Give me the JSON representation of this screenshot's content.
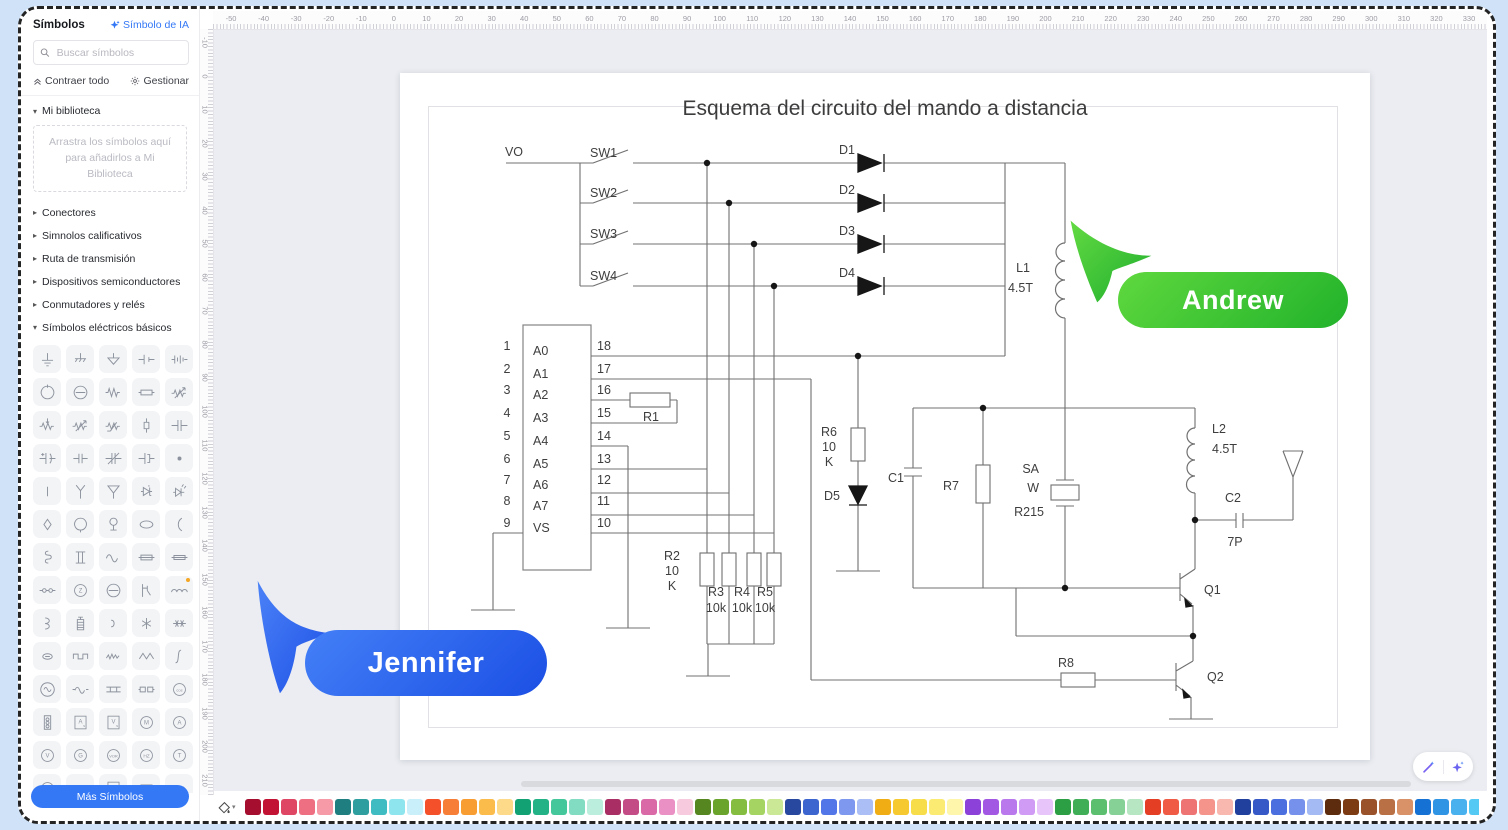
{
  "sidebar": {
    "title": "Símbolos",
    "ai_button": "Símbolo de IA",
    "search_placeholder": "Buscar símbolos",
    "collapse_all": "Contraer todo",
    "manage": "Gestionar",
    "library": {
      "label": "Mi biblioteca",
      "dropzone": "Arrastra los símbolos aquí para añadirlos a Mi Biblioteca"
    },
    "categories": [
      {
        "label": "Conectores",
        "expanded": false
      },
      {
        "label": "Simnolos calificativos",
        "expanded": false
      },
      {
        "label": "Ruta de transmisión",
        "expanded": false
      },
      {
        "label": "Dispositivos semiconductores",
        "expanded": false
      },
      {
        "label": "Conmutadores y relés",
        "expanded": false
      },
      {
        "label": "Símbolos eléctricos básicos",
        "expanded": true
      }
    ],
    "symbols": [
      {
        "n": "earth-ground",
        "g": "gnd1"
      },
      {
        "n": "chassis-ground",
        "g": "gnd2"
      },
      {
        "n": "signal-ground",
        "g": "gnd3"
      },
      {
        "n": "cell",
        "g": "cell"
      },
      {
        "n": "battery",
        "g": "batt"
      },
      {
        "n": "dc-source",
        "g": "circN"
      },
      {
        "n": "node-source",
        "g": "circH"
      },
      {
        "n": "resistor",
        "g": "zig"
      },
      {
        "n": "resistor-box",
        "g": "rbox"
      },
      {
        "n": "varistor",
        "g": "variR"
      },
      {
        "n": "potentiometer",
        "g": "potR"
      },
      {
        "n": "rheostat",
        "g": "variR"
      },
      {
        "n": "thermistor",
        "g": "thermR"
      },
      {
        "n": "surge-arrester",
        "g": "fuseV"
      },
      {
        "n": "capacitor",
        "g": "cap"
      },
      {
        "n": "polarized-capacitor",
        "g": "capP"
      },
      {
        "n": "fixed-capacitor",
        "g": "cap2"
      },
      {
        "n": "trimmer-capacitor",
        "g": "capT"
      },
      {
        "n": "electrolytic-capacitor",
        "g": "capE"
      },
      {
        "n": "junction-dot",
        "g": "dot",
        "f": 1
      },
      {
        "n": "terminal",
        "g": "term"
      },
      {
        "n": "antenna",
        "g": "antY"
      },
      {
        "n": "triangle-antenna",
        "g": "antT"
      },
      {
        "n": "zener-diode",
        "g": "zenD"
      },
      {
        "n": "led",
        "g": "ledD"
      },
      {
        "n": "diamond-indicator",
        "g": "diam"
      },
      {
        "n": "lamp",
        "g": "lamp"
      },
      {
        "n": "indicator-lamp",
        "g": "indic"
      },
      {
        "n": "oval-terminal",
        "g": "oval"
      },
      {
        "n": "arc-contact",
        "g": "arc"
      },
      {
        "n": "coil-hook",
        "g": "shook"
      },
      {
        "n": "transformer-core",
        "g": "tcore"
      },
      {
        "n": "ac-wave",
        "g": "sine"
      },
      {
        "n": "fuse",
        "g": "fboxL"
      },
      {
        "n": "fuse-holder",
        "g": "fboxS"
      },
      {
        "n": "coupler",
        "g": "link"
      },
      {
        "n": "impedance",
        "t": "Z"
      },
      {
        "n": "node-circle",
        "g": "circH"
      },
      {
        "n": "relay-contact",
        "g": "relayO"
      },
      {
        "n": "inductor",
        "g": "coil",
        "badge": 1
      },
      {
        "n": "half-winding",
        "g": "coil3"
      },
      {
        "n": "battery-stack",
        "g": "bstack"
      },
      {
        "n": "contact-hook",
        "g": "hook"
      },
      {
        "n": "crossing",
        "g": "star"
      },
      {
        "n": "multi-crossing",
        "g": "mstar"
      },
      {
        "n": "oval-dash",
        "g": "ovalD"
      },
      {
        "n": "pulse-wave",
        "g": "pulse"
      },
      {
        "n": "noise-wave",
        "g": "noise"
      },
      {
        "n": "sawtooth-wave",
        "g": "triw"
      },
      {
        "n": "integral",
        "g": "integ"
      },
      {
        "n": "ac-source",
        "g": "acirc"
      },
      {
        "n": "sine-wave",
        "g": "sine2"
      },
      {
        "n": "busbar",
        "g": "busb"
      },
      {
        "n": "double-capsule",
        "g": "dbox"
      },
      {
        "n": "cos-phi-meter",
        "t": "cos"
      },
      {
        "n": "traffic-signal",
        "g": "tlight"
      },
      {
        "n": "ampere-second-box",
        "t": "A",
        "box": 1,
        "sub": "s"
      },
      {
        "n": "volt-second-box",
        "t": "V",
        "box": 1,
        "sub": "s"
      },
      {
        "n": "motor",
        "t": "M"
      },
      {
        "n": "ammeter",
        "t": "A"
      },
      {
        "n": "voltmeter",
        "t": "V"
      },
      {
        "n": "generator",
        "t": "G"
      },
      {
        "n": "vor-meter",
        "t": "VOR"
      },
      {
        "n": "frequency-meter",
        "t": "HZ"
      },
      {
        "n": "temperature-meter",
        "t": "T"
      },
      {
        "n": "dash-meter",
        "t": "–"
      },
      {
        "n": "small-rect",
        "g": "srect"
      },
      {
        "n": "and-gate",
        "t": "&",
        "box": 1
      },
      {
        "n": "double-rect",
        "g": "drect"
      },
      {
        "n": "dots-pair",
        "g": "dots2",
        "f": 1
      }
    ],
    "more_button": "Más Símbolos"
  },
  "rulers": {
    "horizontal": {
      "from": -50,
      "to": 330,
      "step": 10
    },
    "vertical": {
      "from": -10,
      "to": 210,
      "step": 10
    }
  },
  "canvas": {
    "title": "Esquema del circuito del mando a distancia"
  },
  "schematic": {
    "vo": "VO",
    "sw1": "SW1",
    "sw2": "SW2",
    "sw3": "SW3",
    "sw4": "SW4",
    "d1": "D1",
    "d2": "D2",
    "d3": "D3",
    "d4": "D4",
    "d5_label": "D5",
    "pins_left": [
      "1",
      "2",
      "3",
      "4",
      "5",
      "6",
      "7",
      "8",
      "9"
    ],
    "pin_names": [
      "A0",
      "A1",
      "A2",
      "A3",
      "A4",
      "A5",
      "A6",
      "A7",
      "VS"
    ],
    "pins_right": [
      "18",
      "17",
      "16",
      "15",
      "14",
      "13",
      "12",
      "11",
      "10"
    ],
    "r1": "R1",
    "r2_lines": [
      "R2",
      "10",
      "K"
    ],
    "r3": "R3",
    "r3_value": "10k",
    "r4": "R4",
    "r4_value": "10k",
    "r5": "R5",
    "r5_value": "10k",
    "r6_lines": [
      "R6",
      "10",
      "K"
    ],
    "r7": "R7",
    "r8": "R8",
    "c1": "C1",
    "c2": "C2",
    "c2_value": "7P",
    "l1": "L1",
    "l1_value": "4.5T",
    "l2": "L2",
    "l2_value": "4.5T",
    "crystal_lines": [
      "SA",
      "W",
      "R215"
    ],
    "q1": "Q1",
    "q2": "Q2"
  },
  "collaborators": [
    {
      "name": "Andrew",
      "color": "#3fcb34"
    },
    {
      "name": "Jennifer",
      "color": "#2e66ef"
    }
  ],
  "palette": [
    "#a50e2e",
    "#c21335",
    "#de4663",
    "#ef6f82",
    "#f79aa7",
    "#1f7f80",
    "#2f9e9f",
    "#3fbcc1",
    "#8fe5ee",
    "#c8effa",
    "#f4512a",
    "#f67e37",
    "#f89d31",
    "#fbbc4c",
    "#fdda8a",
    "#12a173",
    "#22b286",
    "#45c79c",
    "#82dcc1",
    "#bceede",
    "#a82e63",
    "#c34c86",
    "#d96aa7",
    "#eb90c4",
    "#f8cade",
    "#55861f",
    "#6ba42d",
    "#85bd40",
    "#a5d463",
    "#cbe897",
    "#28489f",
    "#3d65cf",
    "#5276e8",
    "#7e98f0",
    "#abbef6",
    "#f0ae14",
    "#f5c92f",
    "#f8dd4b",
    "#fbeb73",
    "#fdf6ab",
    "#8c42d9",
    "#a358e3",
    "#ba78ed",
    "#d09bf4",
    "#e7c5fb",
    "#2c9e44",
    "#40ae56",
    "#5cbf70",
    "#86d296",
    "#b7e6c2",
    "#e43e25",
    "#ef5b44",
    "#ee7373",
    "#f5948a",
    "#f9b8af",
    "#213f9c",
    "#3659c7",
    "#4b6fdf",
    "#7591ec",
    "#a4baf4",
    "#5d2c0f",
    "#7d3b13",
    "#9a522b",
    "#ba7045",
    "#d99267",
    "#1571d3",
    "#3094e5",
    "#4ab1ef",
    "#53c9f3",
    "#7fd7f7",
    "#6f4b3a",
    "#86614c",
    "#9d7b62",
    "#b5947b",
    "#cdb095",
    "#c9c0ae",
    "#dad3c1",
    "#eae5d3",
    "#f6f2e2",
    "#1d1d1d",
    "#3a3a3a",
    "#4e4e4e",
    "#676767",
    "#818181",
    "#9b9b9b",
    "#b6b6b6",
    "#d1d1d1",
    "#ececec"
  ]
}
